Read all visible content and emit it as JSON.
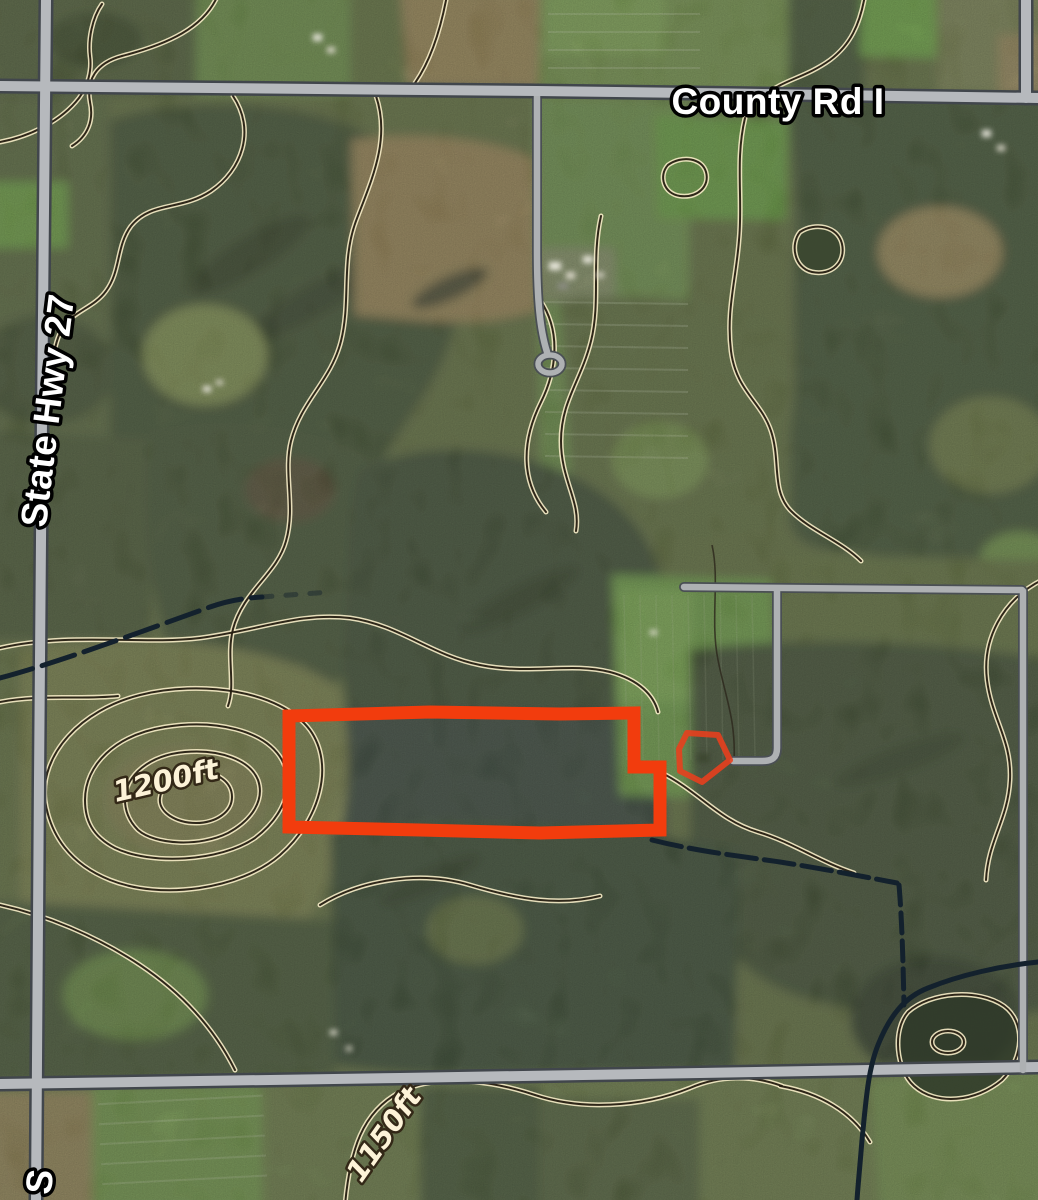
{
  "map": {
    "labels": {
      "county_road": "County Rd I",
      "state_highway": "State Hwy 27",
      "state_highway_partial": "S",
      "contour_1200": "1200ft",
      "contour_1150": "1150ft"
    },
    "parcel_outline": {
      "points": "289,716 430,712 560,714 634,713 634,767 660,767 660,830 540,833 420,830 289,827",
      "color": "#f23c0d"
    },
    "building_site_outline": {
      "points": "687,733 718,735 730,760 702,782 680,771 679,749",
      "color": "#ea3f1c"
    },
    "colors": {
      "road_fill": "#b6b9bd",
      "road_casing": "#41464c",
      "contour_line": "#241c10",
      "contour_casing": "#f3e9c4",
      "stream": "#13212d",
      "parcel_red": "#f23c0d"
    }
  }
}
